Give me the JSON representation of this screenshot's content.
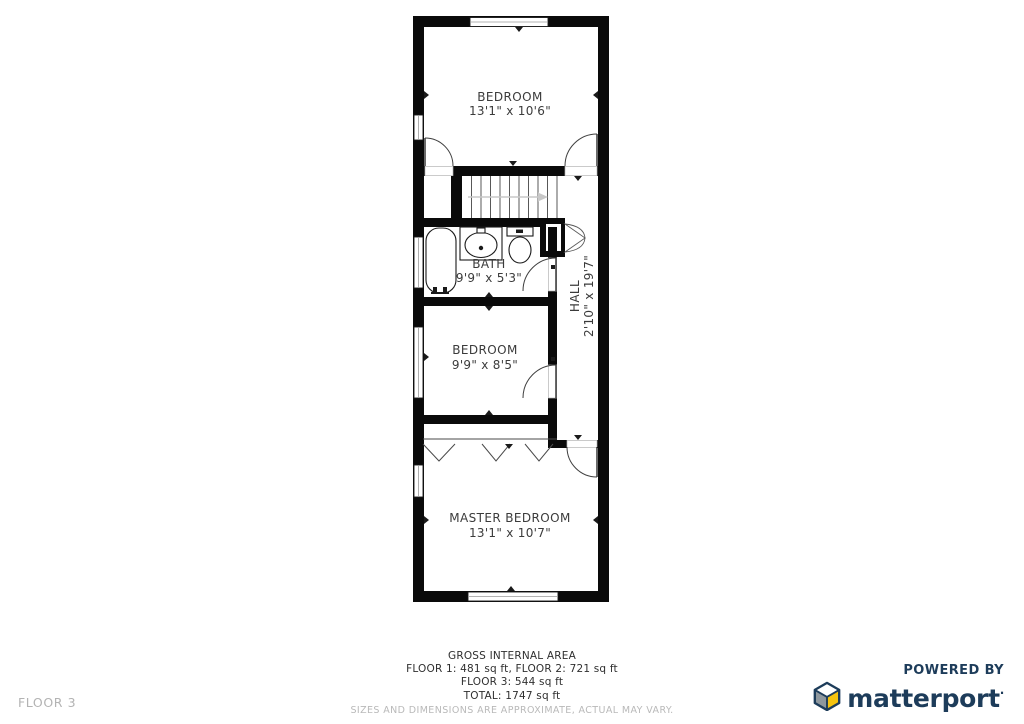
{
  "plan": {
    "rooms": {
      "bedroom_top": {
        "name": "BEDROOM",
        "dims": "13'1\" x 10'6\""
      },
      "bath": {
        "name": "BATH",
        "dims": "9'9\" x 5'3\""
      },
      "hall": {
        "name": "HALL",
        "dims": "2'10\" x 19'7\""
      },
      "bedroom_mid": {
        "name": "BEDROOM",
        "dims": "9'9\" x 8'5\""
      },
      "master": {
        "name": "MASTER BEDROOM",
        "dims": "13'1\" x 10'7\""
      }
    },
    "fixtures": [
      "bathtub",
      "sink",
      "toilet",
      "staircase",
      "wardrobe"
    ],
    "colors": {
      "wall": "#000000",
      "label_text": "#3b3b3b",
      "stairs_arrow": "#c8c8c8"
    }
  },
  "footer": {
    "area_title": "GROSS INTERNAL AREA",
    "area_line_1": "FLOOR 1: 481 sq ft, FLOOR 2: 721 sq ft",
    "area_line_2": "FLOOR 3: 544 sq ft",
    "area_line_3": "TOTAL: 1747 sq ft",
    "disclaimer": "SIZES AND DIMENSIONS ARE APPROXIMATE, ACTUAL MAY VARY.",
    "floor_label": "FLOOR 3"
  },
  "branding": {
    "powered_by": "POWERED BY",
    "brand_name": "matterport",
    "trademark": "·",
    "colors": {
      "navy": "#1d3c5a",
      "cube_yellow": "#f6c40f",
      "cube_gray": "#8f989e",
      "cube_top": "#ffffff"
    }
  }
}
